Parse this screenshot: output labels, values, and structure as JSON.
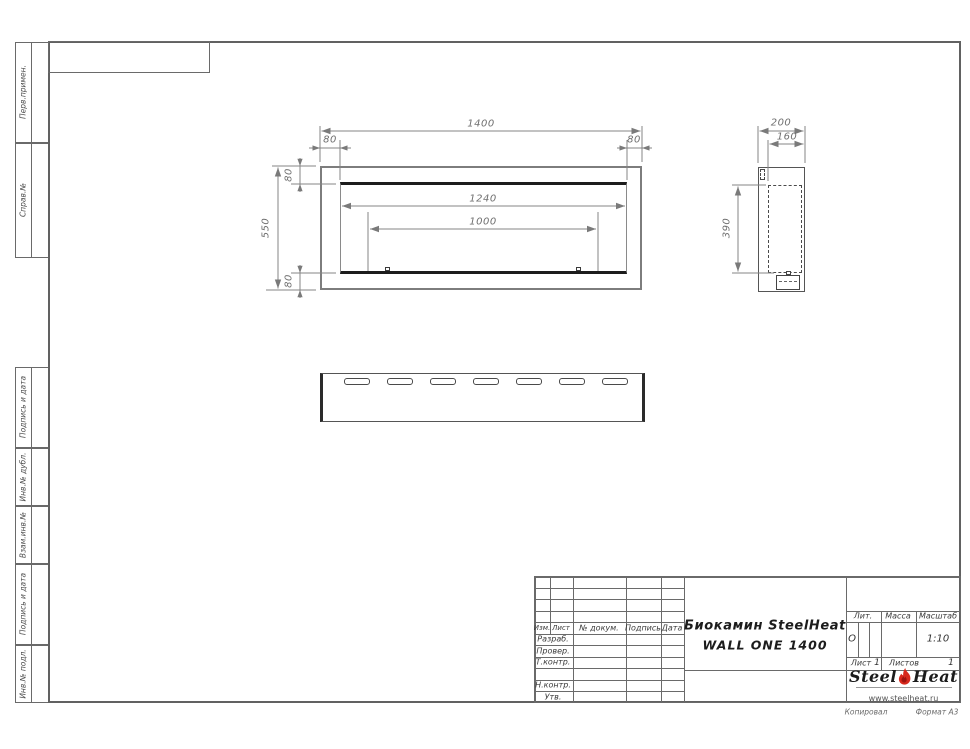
{
  "drawing": {
    "front_view": {
      "dim_width": "1400",
      "dim_left_offset": "80",
      "dim_right_offset": "80",
      "dim_top_offset": "80",
      "dim_bottom_offset": "80",
      "dim_height": "550",
      "dim_opening_width": "1240",
      "dim_burner_width": "1000"
    },
    "side_view": {
      "dim_depth": "200",
      "dim_inner_depth": "160",
      "dim_opening_height": "390"
    }
  },
  "margin_labels": {
    "perv_primen": "Перв.примен.",
    "sprav_no": "Справ.№",
    "podpis_i_data_upper": "Подпись и дата",
    "inv_no_dubl": "Инв.№ дубл.",
    "vzam_inv_no": "Взам.инв.№",
    "podpis_i_data_lower": "Подпись и дата",
    "inv_no_podl": "Инв.№ подл."
  },
  "title_block": {
    "columns": {
      "izm": "Изм.",
      "list": "Лист",
      "no_dokum": "№ докум.",
      "podpis": "Подпись",
      "data": "Дата"
    },
    "roles": {
      "razrab": "Разраб.",
      "prover": "Провер.",
      "t_kontr": "Т.контр.",
      "n_kontr": "Н.контр.",
      "utv": "Утв."
    },
    "title_line1": "Биокамин SteelHeat",
    "title_line2": "WALL ONE 1400",
    "lit_label": "Лит.",
    "lit_value": "О",
    "massa_label": "Масса",
    "masshtab_label": "Масштаб",
    "masshtab_value": "1:10",
    "list_label": "Лист",
    "list_value": "1",
    "listov_label": "Листов",
    "listov_value": "1"
  },
  "logo": {
    "steel": "Steel",
    "heat": "Heat",
    "url": "www.steelheat.ru"
  },
  "footer": {
    "kopiroval": "Копировал",
    "format": "Формат А3"
  }
}
